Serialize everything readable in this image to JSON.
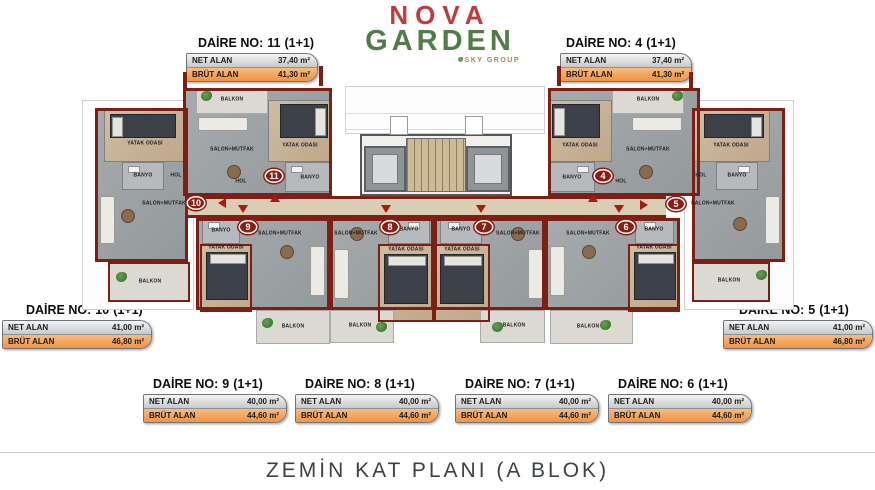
{
  "logo": {
    "brand_top": "NOVA",
    "brand_bottom": "GARDEN",
    "group": "SKY GROUP"
  },
  "labels": {
    "daire_prefix": "DAİRE NO:",
    "net": "NET ALAN",
    "brut": "BRÜT ALAN"
  },
  "apartments": {
    "a11": {
      "no": "11",
      "type": "(1+1)",
      "net": "37,40 m²",
      "brut": "41,30 m²"
    },
    "a4": {
      "no": "4",
      "type": "(1+1)",
      "net": "37,40 m²",
      "brut": "41,30 m²"
    },
    "a10": {
      "no": "10",
      "type": "(1+1)",
      "net": "41,00 m²",
      "brut": "46,80 m²"
    },
    "a5": {
      "no": "5",
      "type": "(1+1)",
      "net": "41,00 m²",
      "brut": "46,80 m²"
    },
    "a9": {
      "no": "9",
      "type": "(1+1)",
      "net": "40,00 m²",
      "brut": "44,60 m²"
    },
    "a8": {
      "no": "8",
      "type": "(1+1)",
      "net": "40,00 m²",
      "brut": "44,60 m²"
    },
    "a7": {
      "no": "7",
      "type": "(1+1)",
      "net": "40,00 m²",
      "brut": "44,60 m²"
    },
    "a6": {
      "no": "6",
      "type": "(1+1)",
      "net": "40,00 m²",
      "brut": "44,60 m²"
    }
  },
  "rooms": {
    "balkon": "BALKON",
    "salon": "SALON+MUTFAK",
    "yatak": "YATAK ODASI",
    "banyo": "BANYO",
    "hol": "HOL"
  },
  "plan": {
    "units": {
      "u11": "11",
      "u4": "4",
      "u10": "10",
      "u5": "5",
      "u9": "9",
      "u8": "8",
      "u7": "7",
      "u6": "6"
    }
  },
  "footer": {
    "title": "ZEMİN KAT PLANI (A BLOK)"
  },
  "colors": {
    "wall": "#7e1f15",
    "brut_orange": "#f2a35c",
    "logo_red": "#c23a3c",
    "logo_green": "#517c47"
  }
}
